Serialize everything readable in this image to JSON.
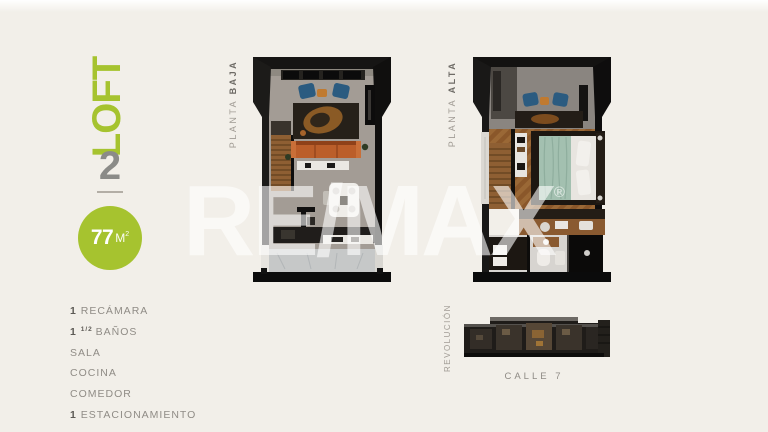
{
  "branding": {
    "loft_label": "LOFT",
    "unit_number": "2",
    "area": {
      "number": "77",
      "unit": "M",
      "sup": "2"
    }
  },
  "features": [
    {
      "bold": "1 ",
      "sup": "",
      "text": "RECÁMARA"
    },
    {
      "bold": "1 ",
      "sup": "1/2 ",
      "text": "BAÑOS"
    },
    {
      "bold": "",
      "sup": "",
      "text": "SALA"
    },
    {
      "bold": "",
      "sup": "",
      "text": "COCINA"
    },
    {
      "bold": "",
      "sup": "",
      "text": "COMEDOR"
    },
    {
      "bold": "1 ",
      "sup": "",
      "text": "ESTACIONAMIENTO"
    }
  ],
  "plans": [
    {
      "label_light": "PLANTA ",
      "label_bold": "BAJA"
    },
    {
      "label_light": "PLANTA ",
      "label_bold": "ALTA"
    }
  ],
  "site": {
    "street_left": "REVOLUCIÓN",
    "street_bottom": "CALLE 7"
  },
  "watermark": {
    "text": "RE/MAX",
    "reg": "®"
  },
  "colors": {
    "accent_green": "#a6c32f",
    "number_gray": "#8b8b88",
    "text_gray": "#908c86",
    "background": "#f2efe9"
  }
}
